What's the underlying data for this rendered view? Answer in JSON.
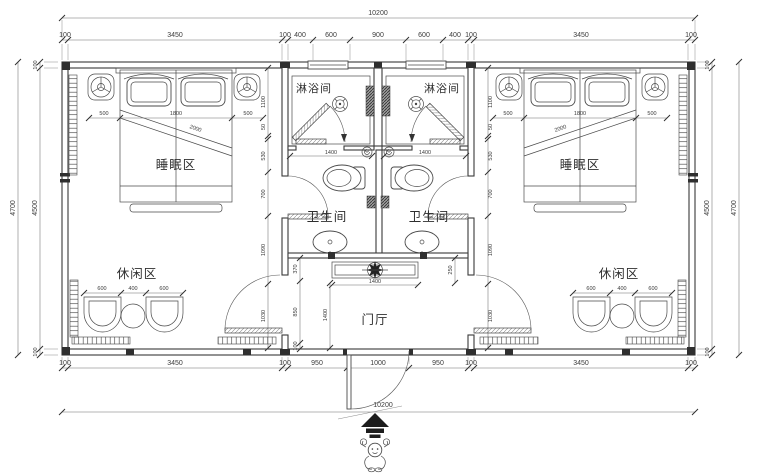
{
  "plan": {
    "rooms": {
      "sleep": "睡眠区",
      "shower": "淋浴间",
      "wc": "卫生间",
      "lounge": "休闲区",
      "foyer": "门厅"
    },
    "dims": {
      "overall_width": "10200",
      "top": [
        "100",
        "3450",
        "100",
        "400",
        "600",
        "900",
        "600",
        "400",
        "100",
        "3450",
        "100"
      ],
      "bottom": [
        "100",
        "3450",
        "100",
        "950",
        "1000",
        "950",
        "100",
        "3450",
        "100"
      ],
      "side_outer": "4700",
      "side_inner": [
        "100",
        "4500",
        "100"
      ],
      "bed": [
        "500",
        "1800",
        "500"
      ],
      "bed_length": "2000",
      "lounge": [
        "600",
        "400",
        "600"
      ],
      "shower_width": "1400",
      "console_width": "1400",
      "foyer_depth": "1400",
      "foyer_side": [
        "370",
        "850",
        "100"
      ],
      "foyer_right": "250",
      "core_side": [
        "1100",
        "50",
        "530",
        "700",
        "1090",
        "1030"
      ]
    },
    "colors": {
      "line": "#3a3a3a",
      "dim": "#6e6e6e",
      "post": "#2f2f2f",
      "bg": "#ffffff"
    }
  }
}
